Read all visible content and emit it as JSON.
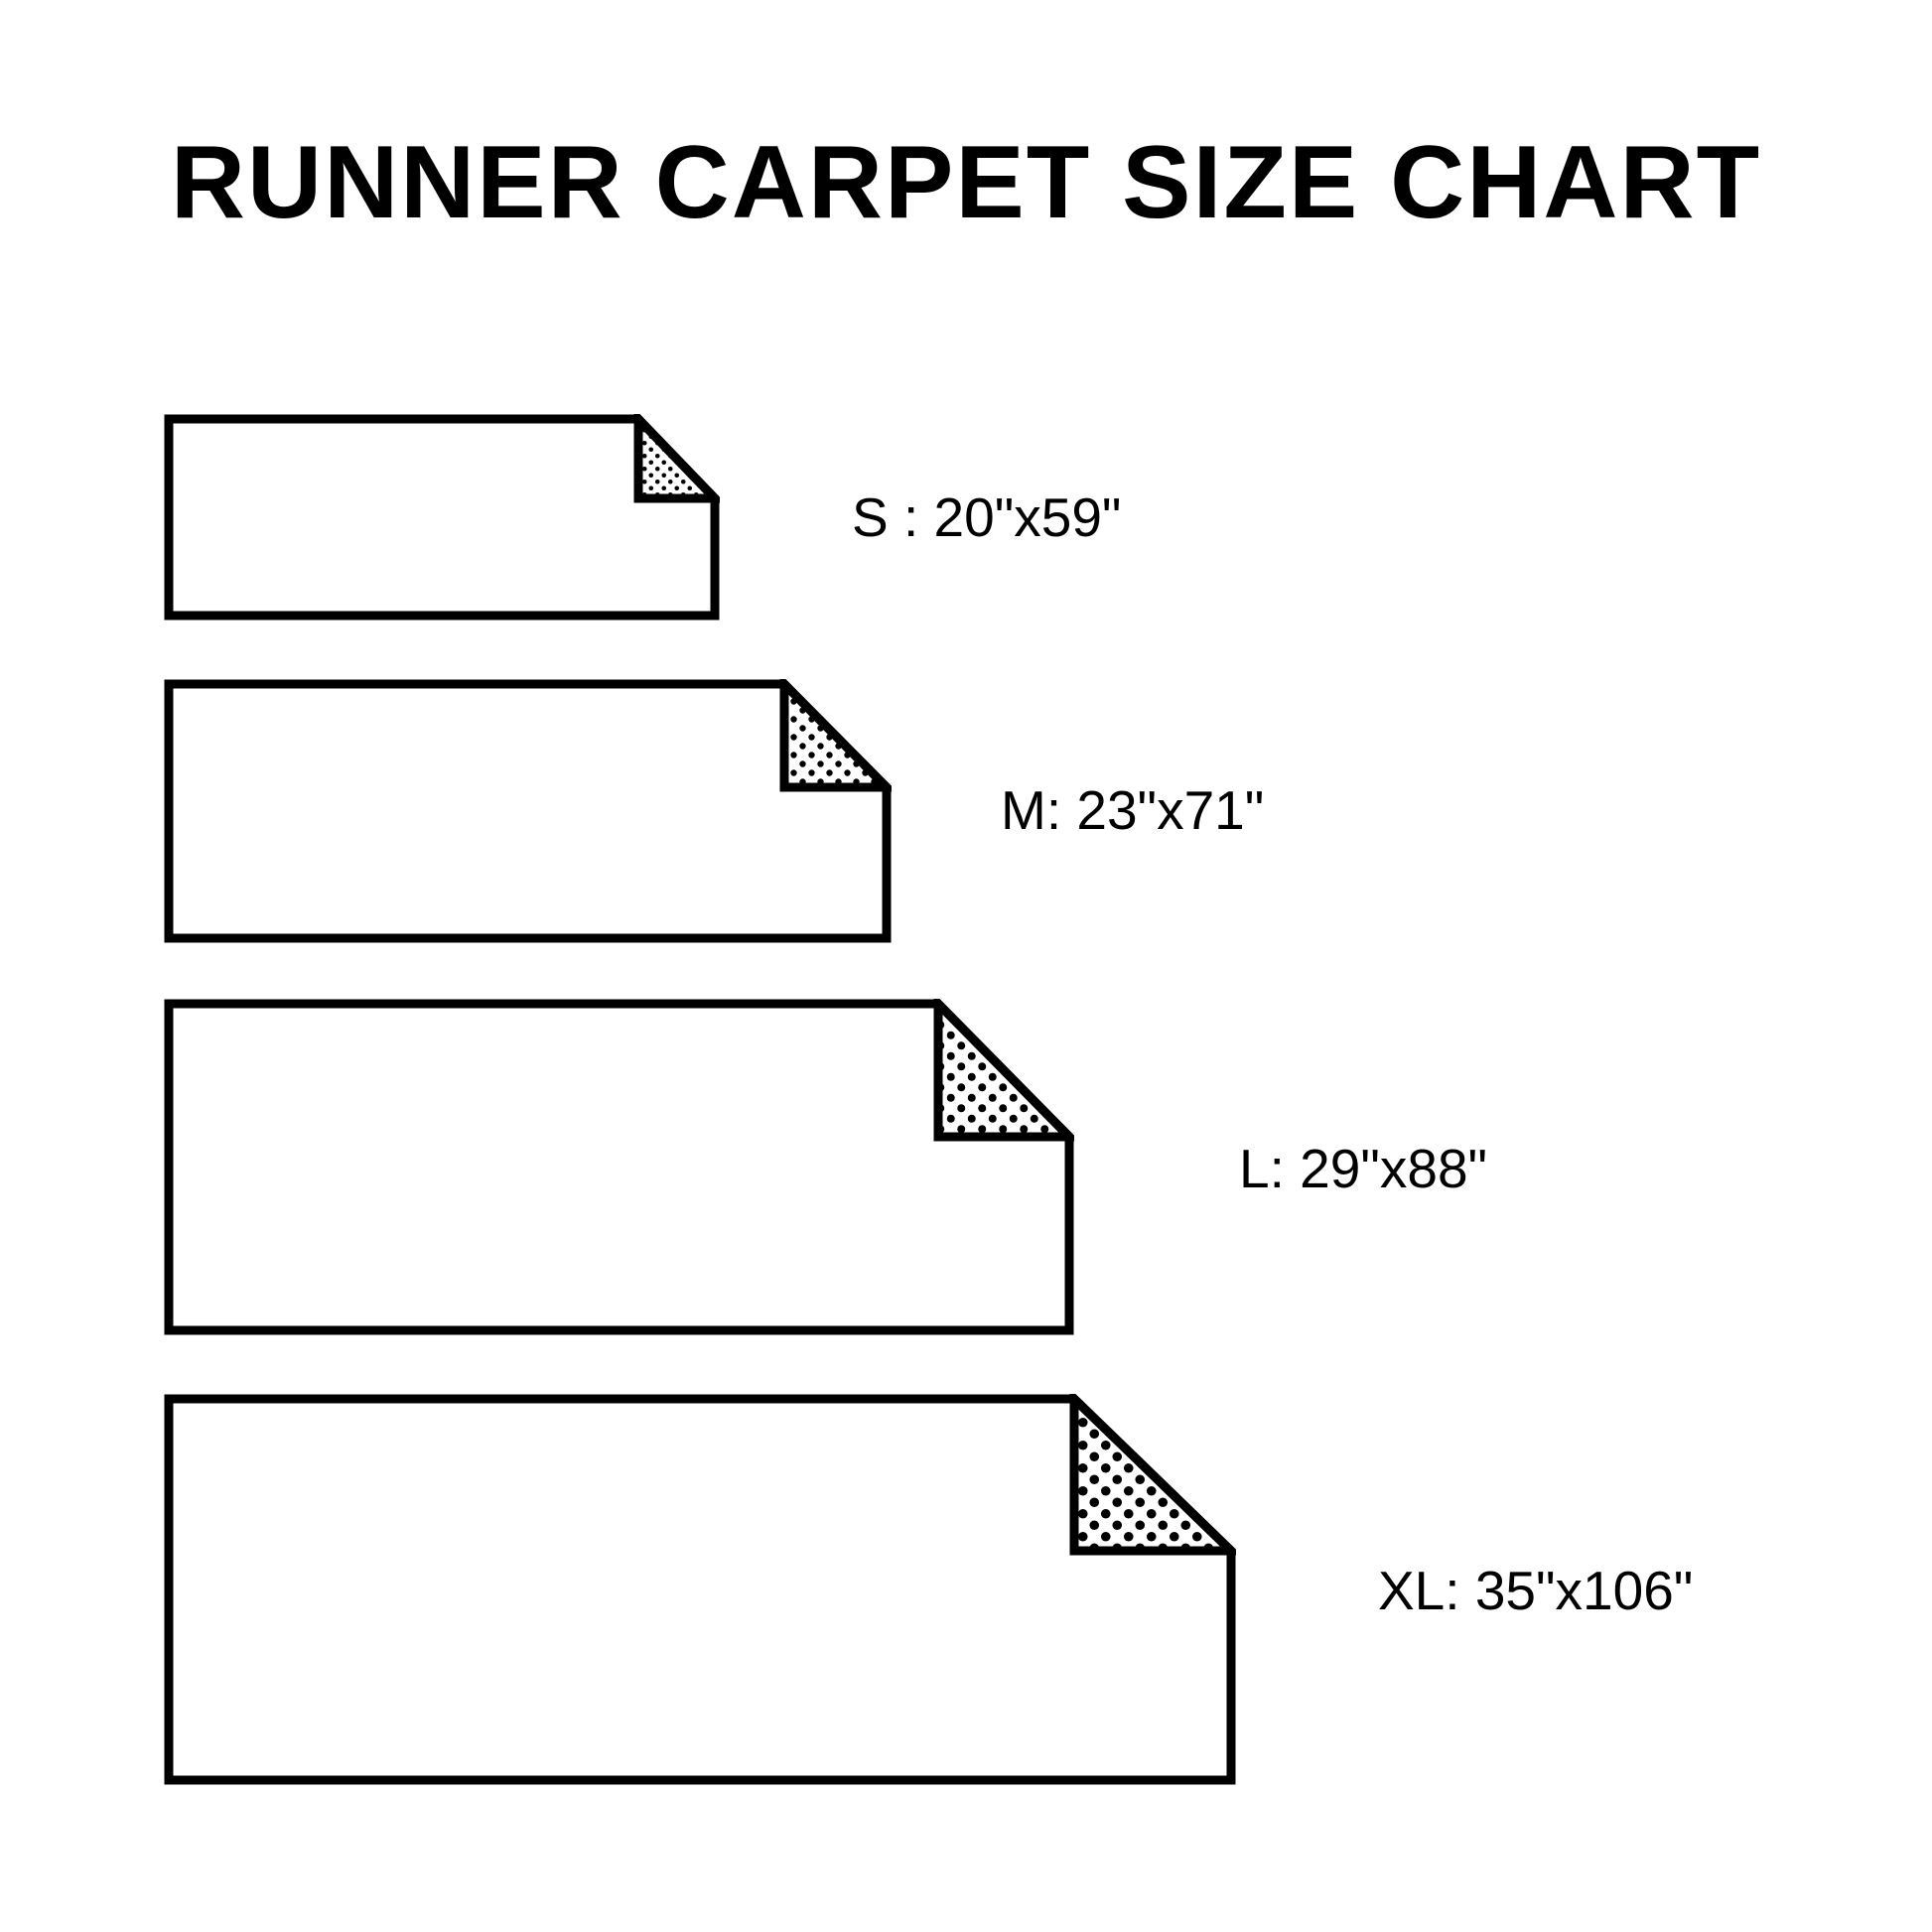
{
  "title": "RUNNER CARPET SIZE CHART",
  "colors": {
    "ink": "#000000",
    "paper": "#ffffff"
  },
  "sizes": [
    {
      "name": "S",
      "label": "S : 20\"x59\"",
      "dimensions": "20\"x59\""
    },
    {
      "name": "M",
      "label": "M: 23\"x71\"",
      "dimensions": "23\"x71\""
    },
    {
      "name": "L",
      "label": "L: 29\"x88\"",
      "dimensions": "29\"x88\""
    },
    {
      "name": "XL",
      "label": "XL: 35\"x106\"",
      "dimensions": "35\"x106\""
    }
  ]
}
